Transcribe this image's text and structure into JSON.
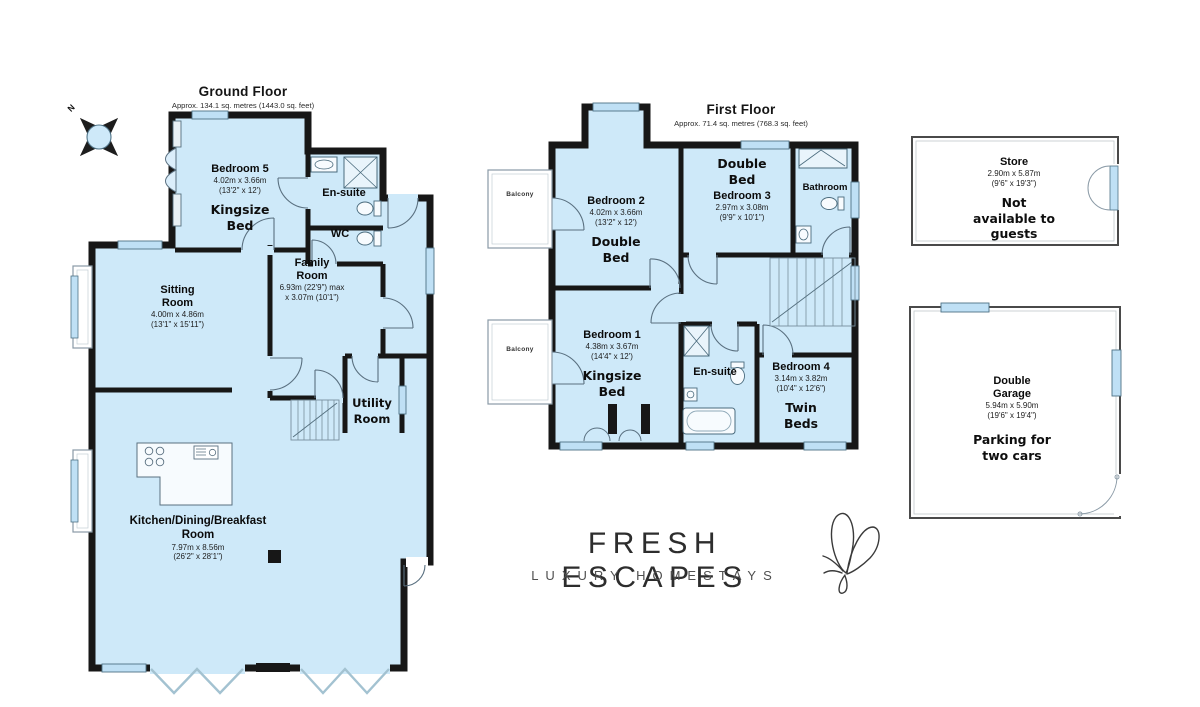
{
  "compass": {
    "north_label": "N"
  },
  "ground_floor": {
    "title": "Ground Floor",
    "subtitle": "Approx. 134.1 sq. metres (1443.0 sq. feet)",
    "bedroom5": {
      "name": "Bedroom 5",
      "dims_m": "4.02m x 3.66m",
      "dims_ft": "(13'2\" x 12')",
      "note_lines": [
        "Kingsize",
        "Bed"
      ]
    },
    "ensuite": {
      "name": "En-suite"
    },
    "wc": {
      "name": "WC"
    },
    "family_room": {
      "name_lines": [
        "Family",
        "Room"
      ],
      "dims_m": "6.93m (22'9\") max",
      "dims_ft": "x 3.07m (10'1\")"
    },
    "sitting_room": {
      "name_lines": [
        "Sitting",
        "Room"
      ],
      "dims_m": "4.00m x 4.86m",
      "dims_ft": "(13'1\" x 15'11\")"
    },
    "utility_room": {
      "name_lines": [
        "Utility",
        "Room"
      ]
    },
    "kitchen": {
      "name_lines": [
        "Kitchen/Dining/Breakfast",
        "Room"
      ],
      "dims_m": "7.97m x 8.56m",
      "dims_ft": "(26'2\" x 28'1\")"
    }
  },
  "first_floor": {
    "title": "First Floor",
    "subtitle": "Approx. 71.4 sq. metres (768.3 sq. feet)",
    "bedroom2": {
      "name": "Bedroom 2",
      "dims_m": "4.02m x 3.66m",
      "dims_ft": "(13'2\" x 12')",
      "note_lines": [
        "Double",
        "Bed"
      ]
    },
    "bedroom3": {
      "name": "Bedroom 3",
      "dims_m": "2.97m x 3.08m",
      "dims_ft": "(9'9\" x 10'1\")",
      "note_lines": [
        "Double",
        "Bed"
      ]
    },
    "bathroom": {
      "name": "Bathroom"
    },
    "bedroom1": {
      "name": "Bedroom 1",
      "dims_m": "4.38m x 3.67m",
      "dims_ft": "(14'4\" x 12')",
      "note_lines": [
        "Kingsize",
        "Bed"
      ]
    },
    "ensuite": {
      "name": "En-suite"
    },
    "bedroom4": {
      "name": "Bedroom 4",
      "dims_m": "3.14m x 3.82m",
      "dims_ft": "(10'4\" x 12'6\")",
      "note_lines": [
        "Twin",
        "Beds"
      ]
    },
    "balcony_top": {
      "name": "Balcony"
    },
    "balcony_bottom": {
      "name": "Balcony"
    }
  },
  "outbuildings": {
    "store": {
      "name": "Store",
      "dims_m": "2.90m x 5.87m",
      "dims_ft": "(9'6\" x 19'3\")",
      "note_lines": [
        "Not",
        "available to",
        "guests"
      ]
    },
    "garage": {
      "name_lines": [
        "Double",
        "Garage"
      ],
      "dims_m": "5.94m x 5.90m",
      "dims_ft": "(19'6\" x 19'4\")",
      "note_lines": [
        "Parking for",
        "two cars"
      ]
    }
  },
  "logo": {
    "brand": "FRESH ESCAPES",
    "tagline": "LUXURY HOMESTAYS"
  },
  "colors": {
    "room_fill": "#cee9f9",
    "wall": "#171717",
    "window": "#bfe0f5"
  }
}
